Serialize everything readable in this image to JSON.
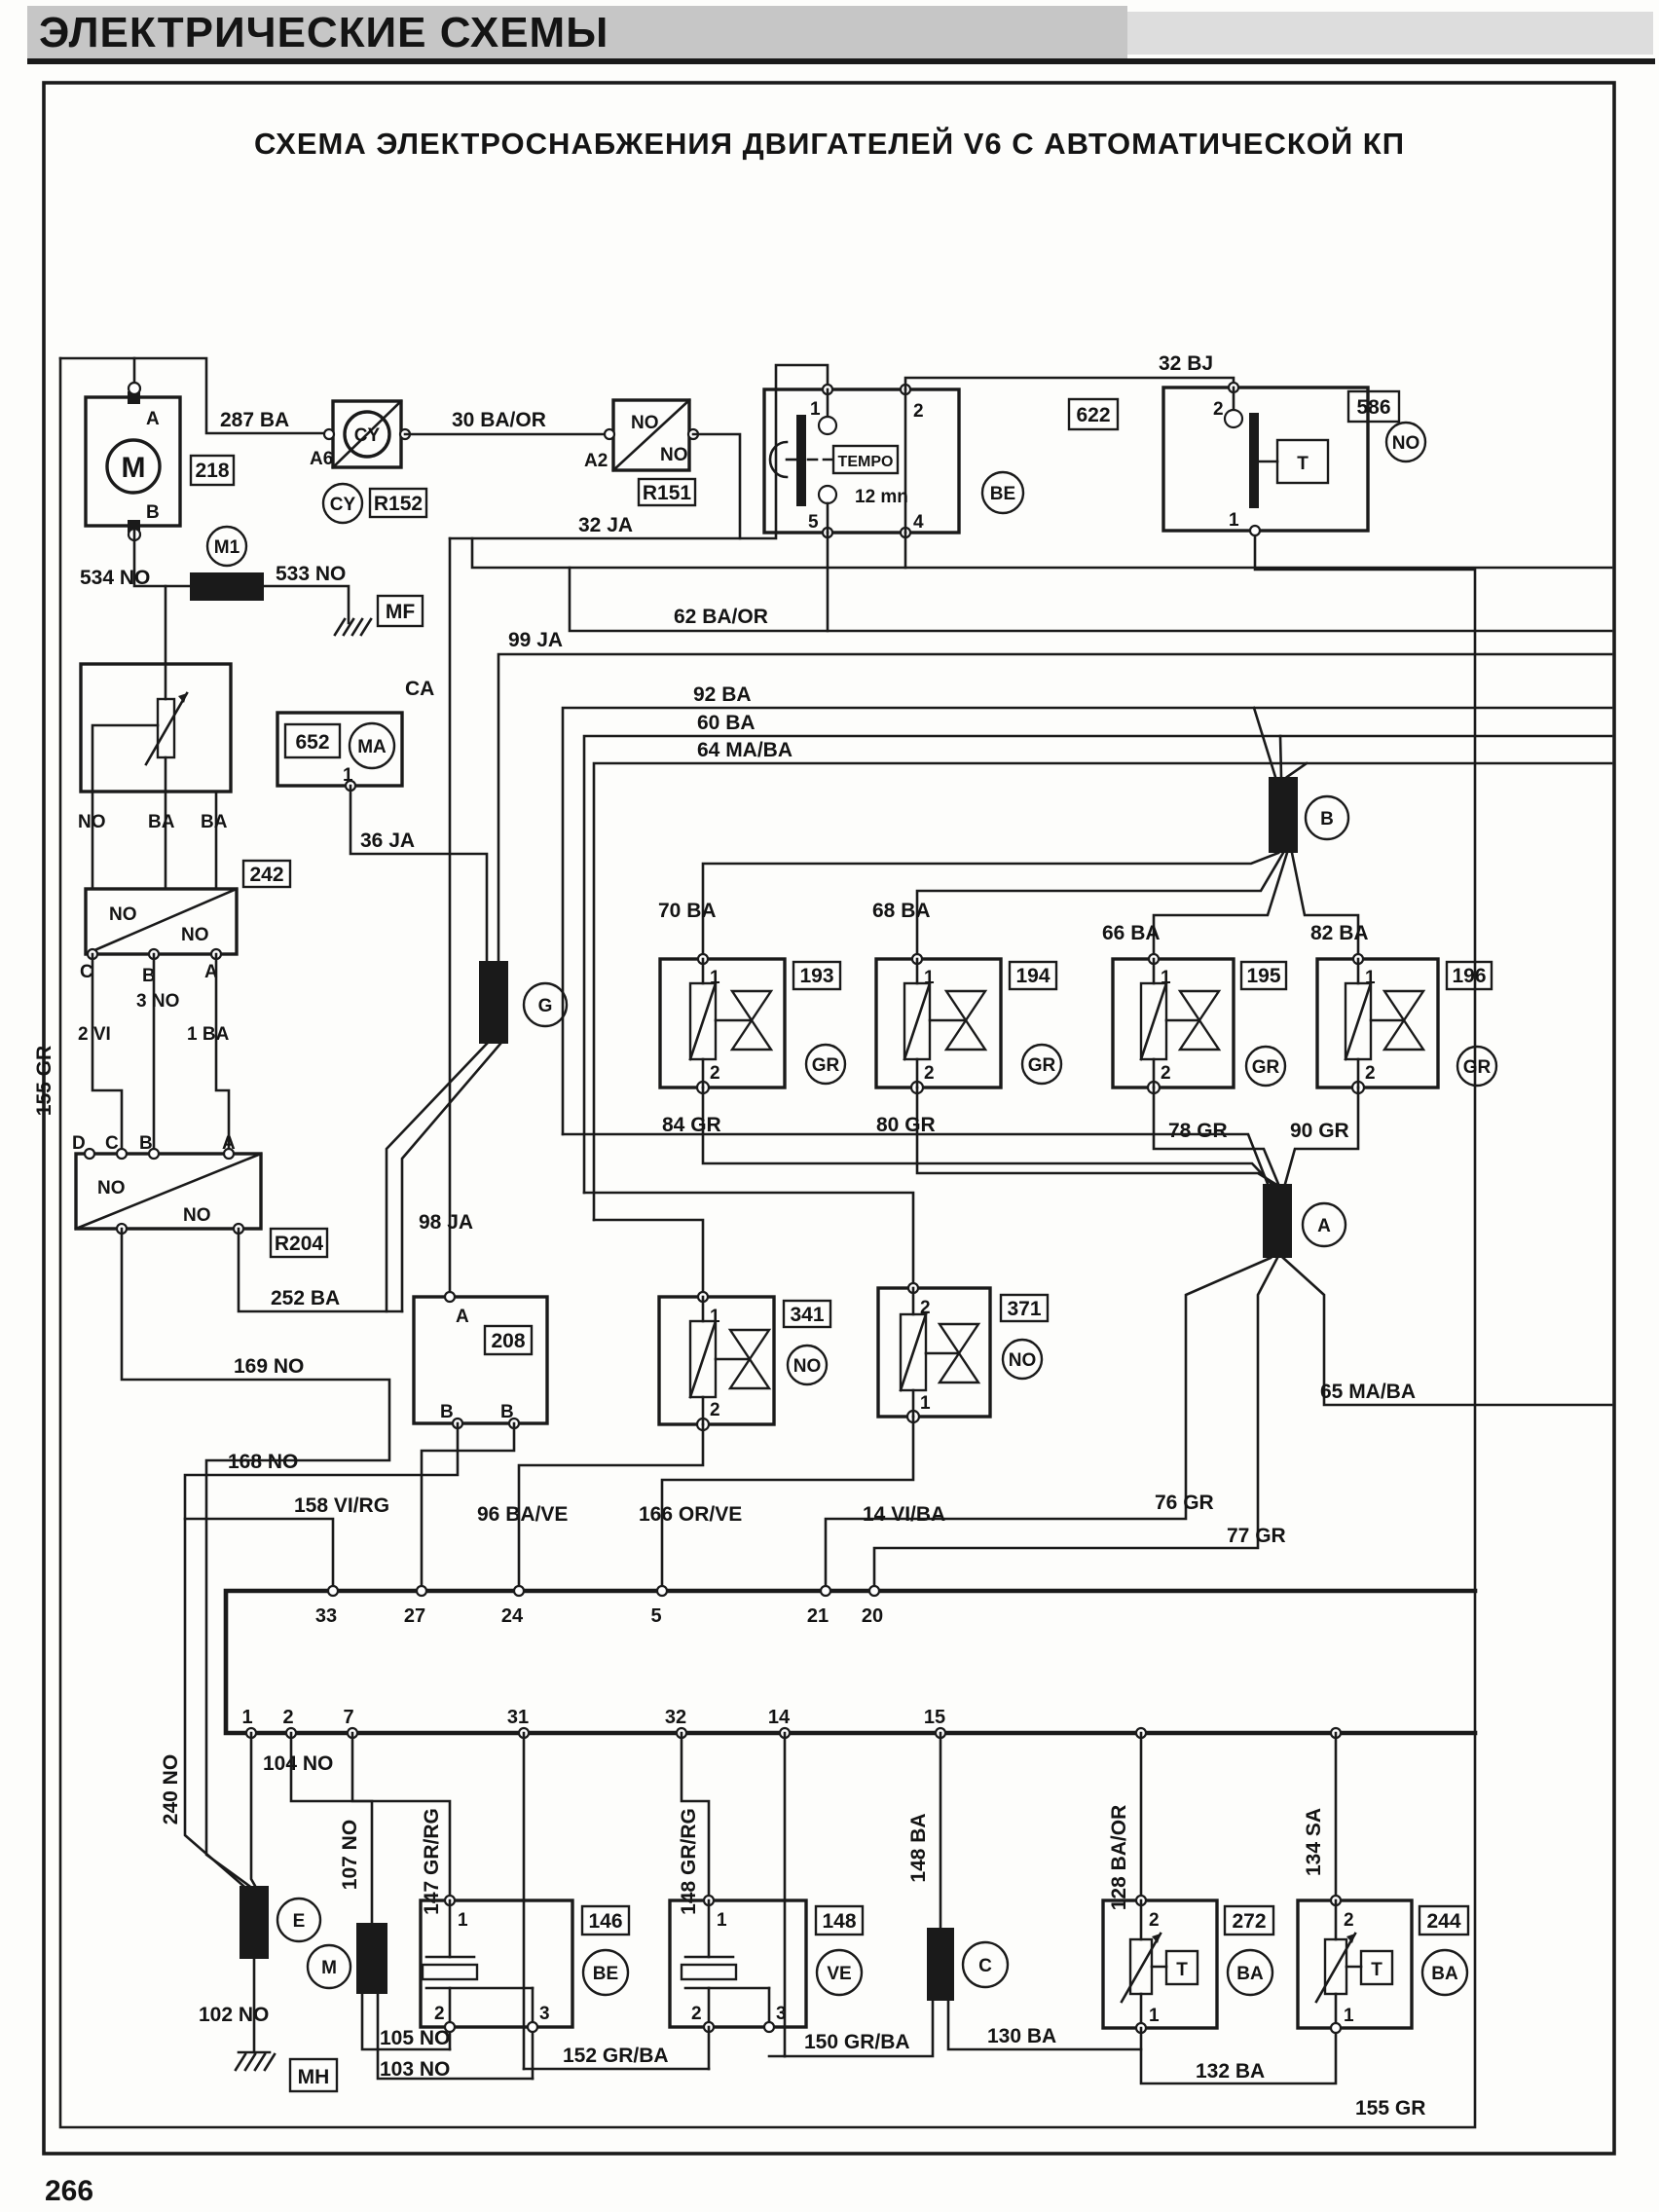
{
  "page": {
    "header": "ЭЛЕКТРИЧЕСКИЕ СХЕМЫ",
    "title": "СХЕМА ЭЛЕКТРОСНАБЖЕНИЯ ДВИГАТЕЛЕЙ V6 С АВТОМАТИЧЕСКОЙ КП",
    "page_number": "266"
  },
  "ids": {
    "m218": "218",
    "r152": "R152",
    "r151": "R151",
    "rel622": "622",
    "th586": "586",
    "c652": "652",
    "s242": "242",
    "r204": "R204",
    "c208": "208",
    "v341": "341",
    "v371": "371",
    "inj193": "193",
    "inj194": "194",
    "inj195": "195",
    "inj196": "196",
    "c146": "146",
    "c148": "148",
    "t272": "272",
    "t244": "244"
  },
  "conn": {
    "cy": "CY",
    "ma": "MA",
    "m": "M",
    "m1": "M1",
    "mf": "MF",
    "mh": "MH",
    "be": "BE",
    "ve": "VE",
    "ba": "BA",
    "gr": "GR",
    "no": "NO",
    "g": "G",
    "b": "B",
    "a": "A",
    "e": "E",
    "mc": "M",
    "c": "C",
    "t": "T",
    "tempo": "TEMPO",
    "ca": "CA"
  },
  "pins": {
    "a": "A",
    "b": "B",
    "a6": "A6",
    "a2": "A2",
    "p1": "1",
    "p2": "2",
    "p3": "3",
    "p4": "4",
    "p5": "5",
    "c": "C",
    "d": "D",
    "no": "NO",
    "ba": "BA",
    "n3no": "3 NO",
    "n2vi": "2 VI",
    "n1ba": "1 BA",
    "t12mn": "12 mn"
  },
  "wires": {
    "w287": "287 BA",
    "w30": "30 BA/OR",
    "w534": "534 NO",
    "w533": "533 NO",
    "w32ja": "32 JA",
    "w32bj": "32 BJ",
    "w62": "62 BA/OR",
    "w99": "99 JA",
    "w92": "92 BA",
    "w60": "60 BA",
    "w64": "64 MA/BA",
    "w36": "36 JA",
    "w70": "70 BA",
    "w68": "68 BA",
    "w66": "66 BA",
    "w82": "82 BA",
    "w84": "84 GR",
    "w80": "80 GR",
    "w78": "78 GR",
    "w90": "90 GR",
    "w98": "98 JA",
    "w252": "252 BA",
    "w169": "169 NO",
    "w168": "168 NO",
    "w158": "158 VI/RG",
    "w96": "96 BA/VE",
    "w166": "166 OR/VE",
    "w14": "14 VI/BA",
    "w76": "76 GR",
    "w77": "77 GR",
    "w65": "65 MA/BA",
    "w155": "155 GR",
    "w240": "240 NO",
    "w104": "104 NO",
    "w107": "107 NO",
    "w102": "102 NO",
    "w105": "105 NO",
    "w103": "103 NO",
    "w147": "147 GR/RG",
    "w148g": "148 GR/RG",
    "w148b": "148 BA",
    "w128": "128 BA/OR",
    "w134": "134 SA",
    "w152": "152 GR/BA",
    "w150": "150 GR/BA",
    "w130": "130 BA",
    "w132": "132 BA"
  },
  "bus1": [
    "33",
    "27",
    "24",
    "5",
    "21",
    "20"
  ],
  "bus2": [
    "1",
    "2",
    "7",
    "31",
    "32",
    "14",
    "15"
  ]
}
